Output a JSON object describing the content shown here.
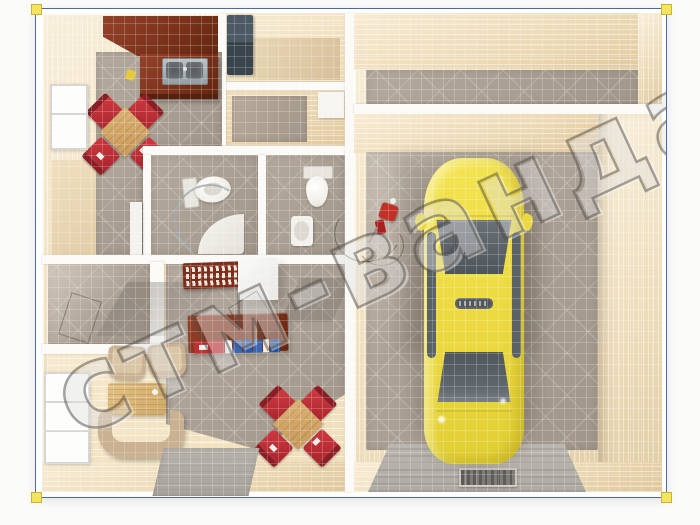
{
  "image": {
    "kind": "3d-floor-plan-top-view-render",
    "subject": "single-storey house with attached garage and yellow sedan"
  },
  "watermark": {
    "text": "стм-ванда",
    "angle_deg": -25
  },
  "frame": {
    "border_color": "#4e6a9c",
    "corner_handle_color": "#f4e55e",
    "margin_background": "#ffffff"
  },
  "palette": {
    "wall_beige": "#eeddbb",
    "wall_shadow": "#dfc79c",
    "partition_white": "#fbfaf7",
    "floor_tile_gray": "#a89d91",
    "floor_wood": "#f2e3c4",
    "furniture_mahogany": "#7b321b",
    "chair_red": "#c5313a",
    "table_wood": "#d4ab6c",
    "sofa_beige": "#c9b191",
    "fixture_white": "#f3f1ea",
    "car_yellow": "#eedd44",
    "car_glass": "#596066",
    "ramp_gray": "#b6b2ac",
    "fridge_slate": "#44525c",
    "book_colors": [
      "#bf2f33",
      "#f2f0ea",
      "#3a67b5"
    ]
  },
  "house": {
    "rooms": [
      {
        "name": "kitchen",
        "furniture": [
          "l-shaped-counter",
          "double-sink",
          "dining-table",
          "four-red-chairs",
          "window"
        ]
      },
      {
        "name": "pantry",
        "furniture": [
          "dark-cabinet"
        ]
      },
      {
        "name": "hall",
        "furniture": []
      },
      {
        "name": "bathroom",
        "furniture": [
          "toilet",
          "corner-shower",
          "shower-tray",
          "door"
        ]
      },
      {
        "name": "wc",
        "furniture": [
          "toilet",
          "wash-basin"
        ]
      },
      {
        "name": "office-nook",
        "furniture": [
          "desk",
          "keyboard-unit",
          "white-cabinet",
          "book-row"
        ]
      },
      {
        "name": "entry",
        "furniture": []
      },
      {
        "name": "living-room",
        "furniture": [
          "two-armchairs",
          "corner-sofa",
          "coffee-table",
          "dining-table",
          "four-red-chairs",
          "window",
          "gray-walkway"
        ]
      }
    ]
  },
  "garage": {
    "rooms": [
      {
        "name": "workshop-strip",
        "furniture": []
      },
      {
        "name": "garage",
        "furniture": [
          "car",
          "ramp-with-drain",
          "red-equipment-with-hose"
        ]
      }
    ],
    "car": {
      "type": "sedan-top-view",
      "body_color": "#eedd44",
      "glass_color": "#596066",
      "roof_badge_illegible": true
    }
  }
}
